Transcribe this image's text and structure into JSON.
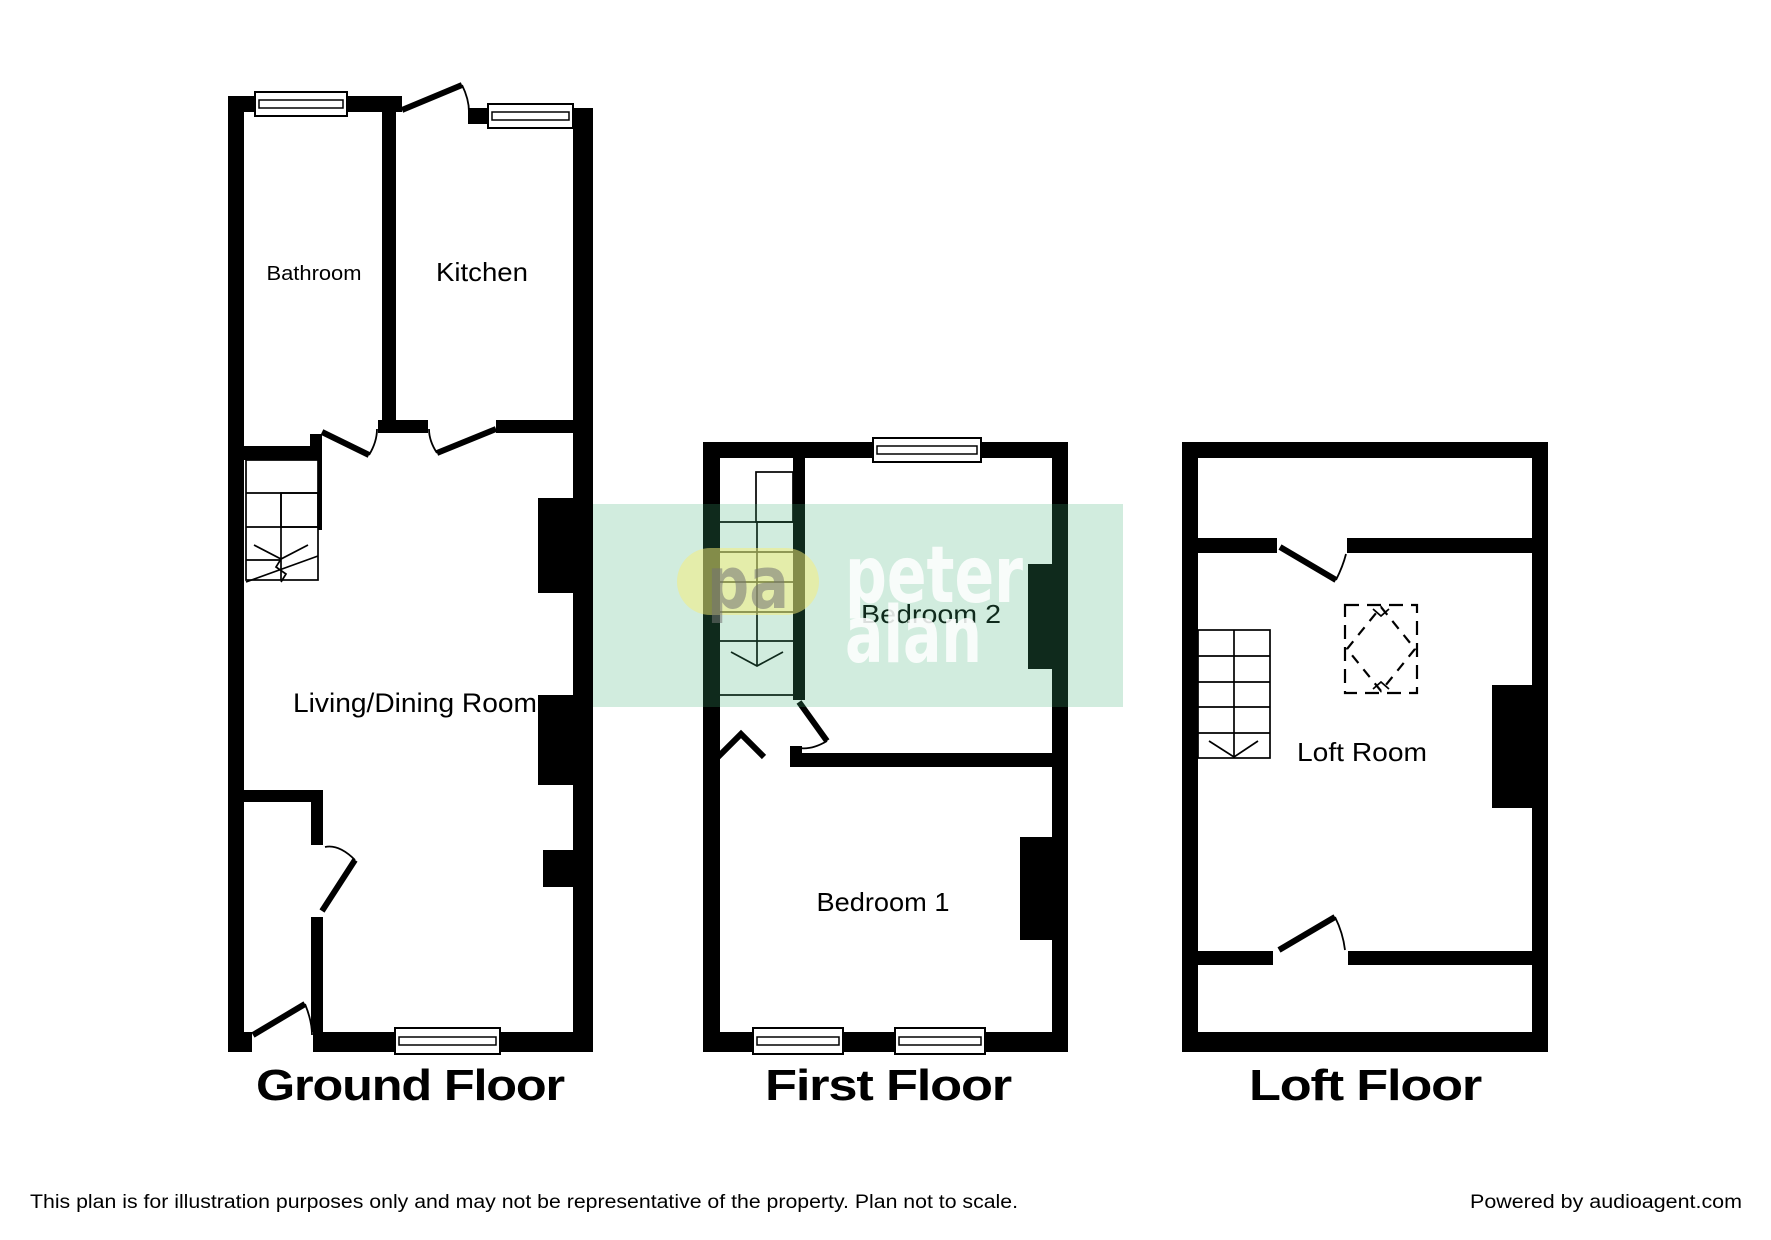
{
  "watermark": {
    "logo_initials": "pa",
    "brand_line1": "peter",
    "brand_line2": "alan",
    "band_color": "#3EB173",
    "oval_color": "#F8ED75"
  },
  "floors": {
    "ground": {
      "label": "Ground Floor",
      "rooms": {
        "bathroom": "Bathroom",
        "kitchen": "Kitchen",
        "living": "Living/Dining Room"
      }
    },
    "first": {
      "label": "First Floor",
      "rooms": {
        "bedroom2": "Bedroom 2",
        "bedroom1": "Bedroom 1"
      }
    },
    "loft": {
      "label": "Loft Floor",
      "rooms": {
        "loft": "Loft Room"
      }
    }
  },
  "footer": {
    "disclaimer": "This plan is for illustration purposes only and may not be representative of the property. Plan not to scale.",
    "credit": "Powered by audioagent.com"
  }
}
